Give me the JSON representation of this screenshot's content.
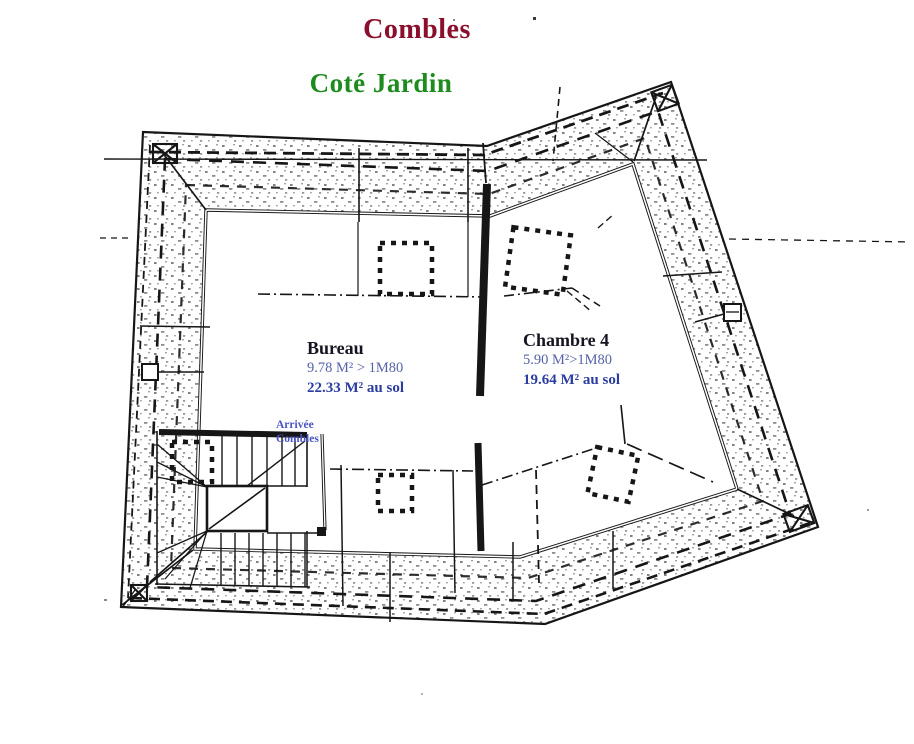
{
  "page": {
    "title": "Combles",
    "subtitle": "Coté Jardin"
  },
  "colors": {
    "title": "#8a0f2d",
    "subtitle": "#1d8b1d",
    "room_name": "#151521",
    "area_above_text": "#5563a8",
    "area_floor_text": "#2c3da0",
    "stair_label": "#4a55c4",
    "drawing_line": "#161616",
    "background": "#ffffff"
  },
  "rooms": [
    {
      "name": "Bureau",
      "area_above_1m80": "9.78 M² > 1M80",
      "area_floor": "22.33 M² au sol"
    },
    {
      "name": "Chambre 4",
      "area_above_1m80": "5.90 M²>1M80",
      "area_floor": "19.64 M² au sol"
    }
  ],
  "stairs": {
    "label_line1": "Arrivée",
    "label_line2": "Combles"
  }
}
